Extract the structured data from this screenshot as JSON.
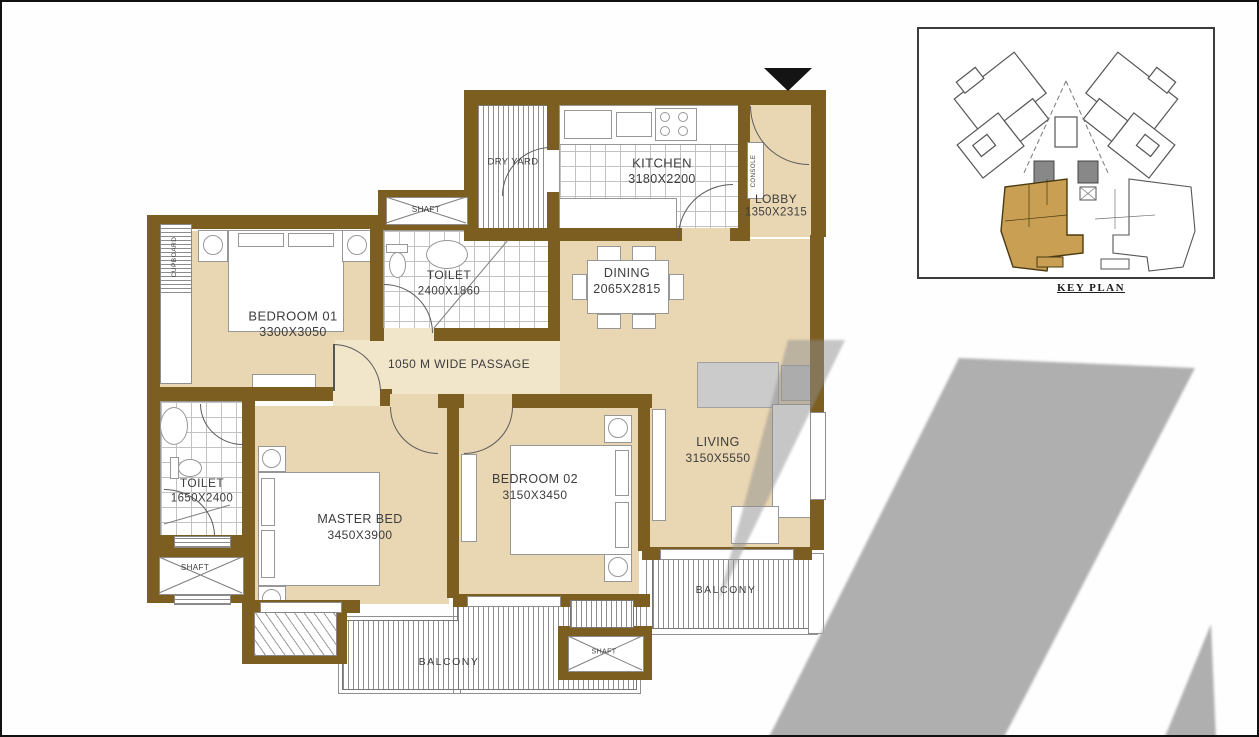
{
  "colors": {
    "wall": "#7c5e21",
    "floor": "#e9d6b3",
    "floor-light": "#f2e6ca",
    "watermark": "#ababab",
    "highlight": "#c89f53",
    "ink": "#3d3d3d"
  },
  "rooms": {
    "dry_yard": {
      "name": "DRY YARD"
    },
    "kitchen": {
      "name": "KITCHEN",
      "dim": "3180X2200"
    },
    "lobby": {
      "name": "LOBBY",
      "dim": "1350X2315"
    },
    "toilet_top": {
      "name": "TOILET",
      "dim": "2400X1860"
    },
    "dining": {
      "name": "DINING",
      "dim": "2065X2815"
    },
    "bedroom_01": {
      "name": "BEDROOM 01",
      "dim": "3300X3050"
    },
    "passage": {
      "label": "1050 M WIDE PASSAGE"
    },
    "toilet_left": {
      "name": "TOILET",
      "dim": "1650X2400"
    },
    "master_bed": {
      "name": "MASTER BED",
      "dim": "3450X3900"
    },
    "bedroom_02": {
      "name": "BEDROOM 02",
      "dim": "3150X3450"
    },
    "living": {
      "name": "LIVING",
      "dim": "3150X5550"
    },
    "balcony_living": {
      "name": "BALCONY"
    },
    "balcony_bedrooms": {
      "name": "BALCONY"
    },
    "shaft_top": {
      "name": "SHAFT"
    },
    "shaft_left": {
      "name": "SHAFT"
    },
    "shaft_bottom": {
      "name": "SHAFT"
    },
    "cupboard": {
      "name": "CUPBOARD"
    },
    "console": {
      "name": "CONSOLE"
    }
  },
  "key_plan": {
    "caption": "KEY PLAN"
  }
}
